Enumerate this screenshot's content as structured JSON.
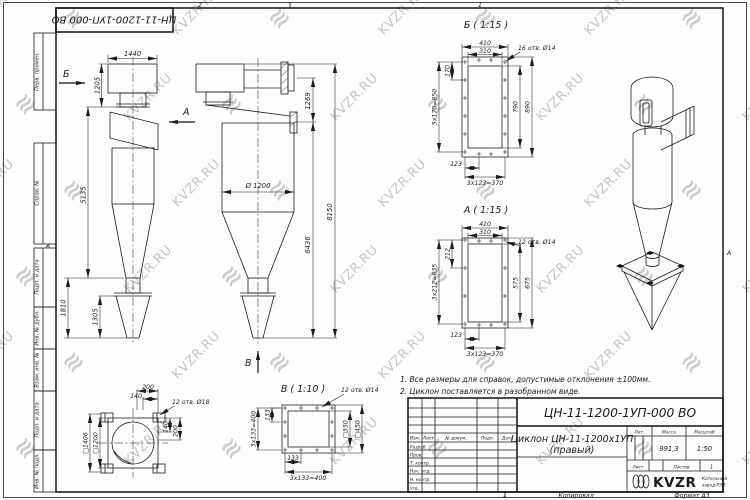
{
  "sheet": {
    "doc_number": "ЦН-11-1200-1УП-000 ВО",
    "product_line1": "Циклон ЦН-11-1200х1УП",
    "product_line2": "(правый)",
    "mass_value": "991,3",
    "scale_value": "1:50",
    "sheets_count": "1",
    "labels": {
      "lit": "Лит.",
      "mass": "Масса",
      "scale": "Масштаб",
      "sheet": "Лист",
      "sheets": "Листов",
      "copied": "Копировал",
      "format": "Формат А3"
    },
    "cols": {
      "c0": "Изм.",
      "c1": "Лист",
      "c2": "№ докум.",
      "c3": "Подп.",
      "c4": "Дата"
    },
    "rows": {
      "r0": "Разраб.",
      "r1": "Пров.",
      "r2": "Т. контр.",
      "r3": "Нач. отд.",
      "r4": "Н. контр.",
      "r5": "Утв."
    },
    "strip": {
      "s0": "Перв. примен.",
      "s1": "Справ. №",
      "s2": "Подп. и дата",
      "s3": "Инв. № дубл.",
      "s4": "Взам. инв. №",
      "s5": "Подп. и дата",
      "s6": "Инв. № подл."
    },
    "zones": {
      "t2": "2",
      "t1": "1",
      "b1": "1",
      "la": "А",
      "ra": "А"
    },
    "notes": {
      "n1": "1. Все размеры для справок, допустимые отклонения ±100мм.",
      "n2": "2. Циклон поставляется в разобранном виде."
    }
  },
  "brand": {
    "watermark": "KVZR.RU",
    "logo": "KVZR",
    "logo_sub1": "Котельный",
    "logo_sub2": "завод РЭП"
  },
  "views": {
    "front": {
      "label_b": "Б",
      "label_a": "А",
      "dim_w": "1440",
      "dim_h1": "1205",
      "dim_h2": "5135",
      "dim_h3": "1810",
      "dim_h4": "1305"
    },
    "side": {
      "label_v": "В",
      "dim_flange": "1269",
      "dim_total": "8150",
      "dim_mid": "6436",
      "dim_dia": "Ø 1200"
    },
    "db": {
      "title": "Б ( 1:15 )",
      "holes": "16 отв. Ø14",
      "w1": "410",
      "w2": "310",
      "p": "170",
      "ps": "5х170=850",
      "h1": "790",
      "h2": "890",
      "bp": "123",
      "bps": "3х123=370"
    },
    "da": {
      "title": "А ( 1:15 )",
      "holes": "12 отв. Ø14",
      "w1": "410",
      "w2": "310",
      "p": "212",
      "ps": "3х212=635",
      "h1": "575",
      "h2": "675",
      "bp": "123",
      "bps": "3х123=370"
    },
    "dv": {
      "title": "В ( 1:10 )",
      "holes": "12 отв. Ø14",
      "pl": "133",
      "psl": "3х133=400",
      "pb": "133",
      "psb": "3х133=400",
      "sq_in": "□350",
      "sq_out": "□450"
    },
    "plan": {
      "holes": "12 отв. Ø18",
      "d200t": "200",
      "d140t": "140",
      "d140r": "140",
      "d200r": "200",
      "sq_out": "□1406",
      "sq_in": "□1200"
    }
  }
}
